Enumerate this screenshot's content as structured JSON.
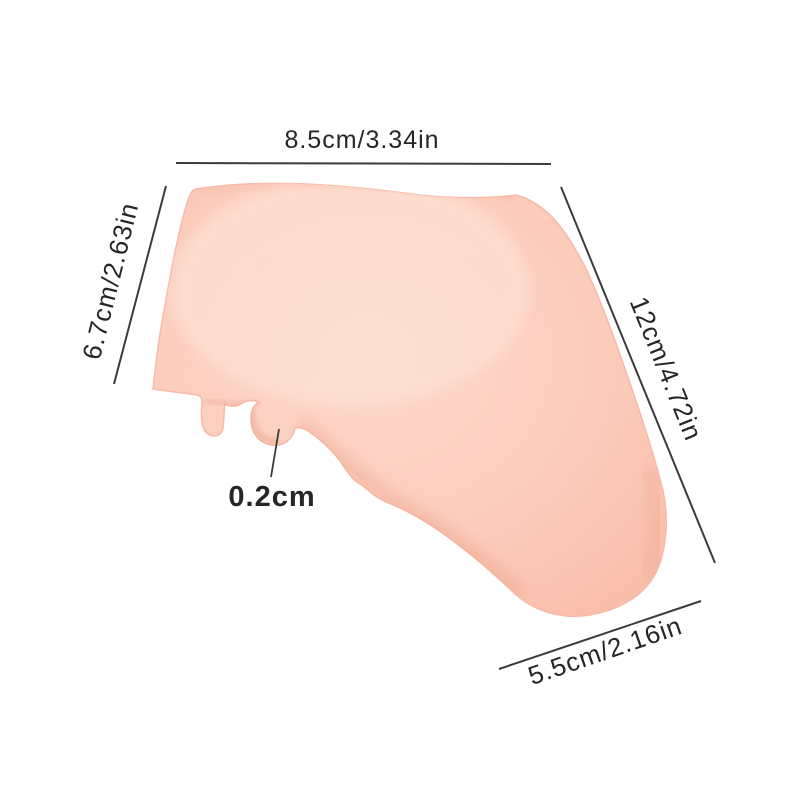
{
  "page": {
    "background": "#ffffff"
  },
  "product": {
    "fill_center": "#fdd8cb",
    "fill_mid": "#fccdbd",
    "fill_edge": "#f9bca8",
    "edge_line": "#f7bba7",
    "shadow_tone": "#eb9d82",
    "deep_shadow_tone": "#e08f75",
    "highlight_tone": "#fee7dc"
  },
  "annotation": {
    "line_color": "#3b3b3b",
    "text_color": "#262626",
    "dimensions": [
      {
        "id": "top-width",
        "label": "8.5cm/3.34in"
      },
      {
        "id": "left-height",
        "label": "6.7cm/2.63in"
      },
      {
        "id": "right-length",
        "label": "12cm/4.72in"
      },
      {
        "id": "thickness",
        "label": "0.2cm"
      },
      {
        "id": "bottom-width",
        "label": "5.5cm/2.16in"
      }
    ]
  }
}
